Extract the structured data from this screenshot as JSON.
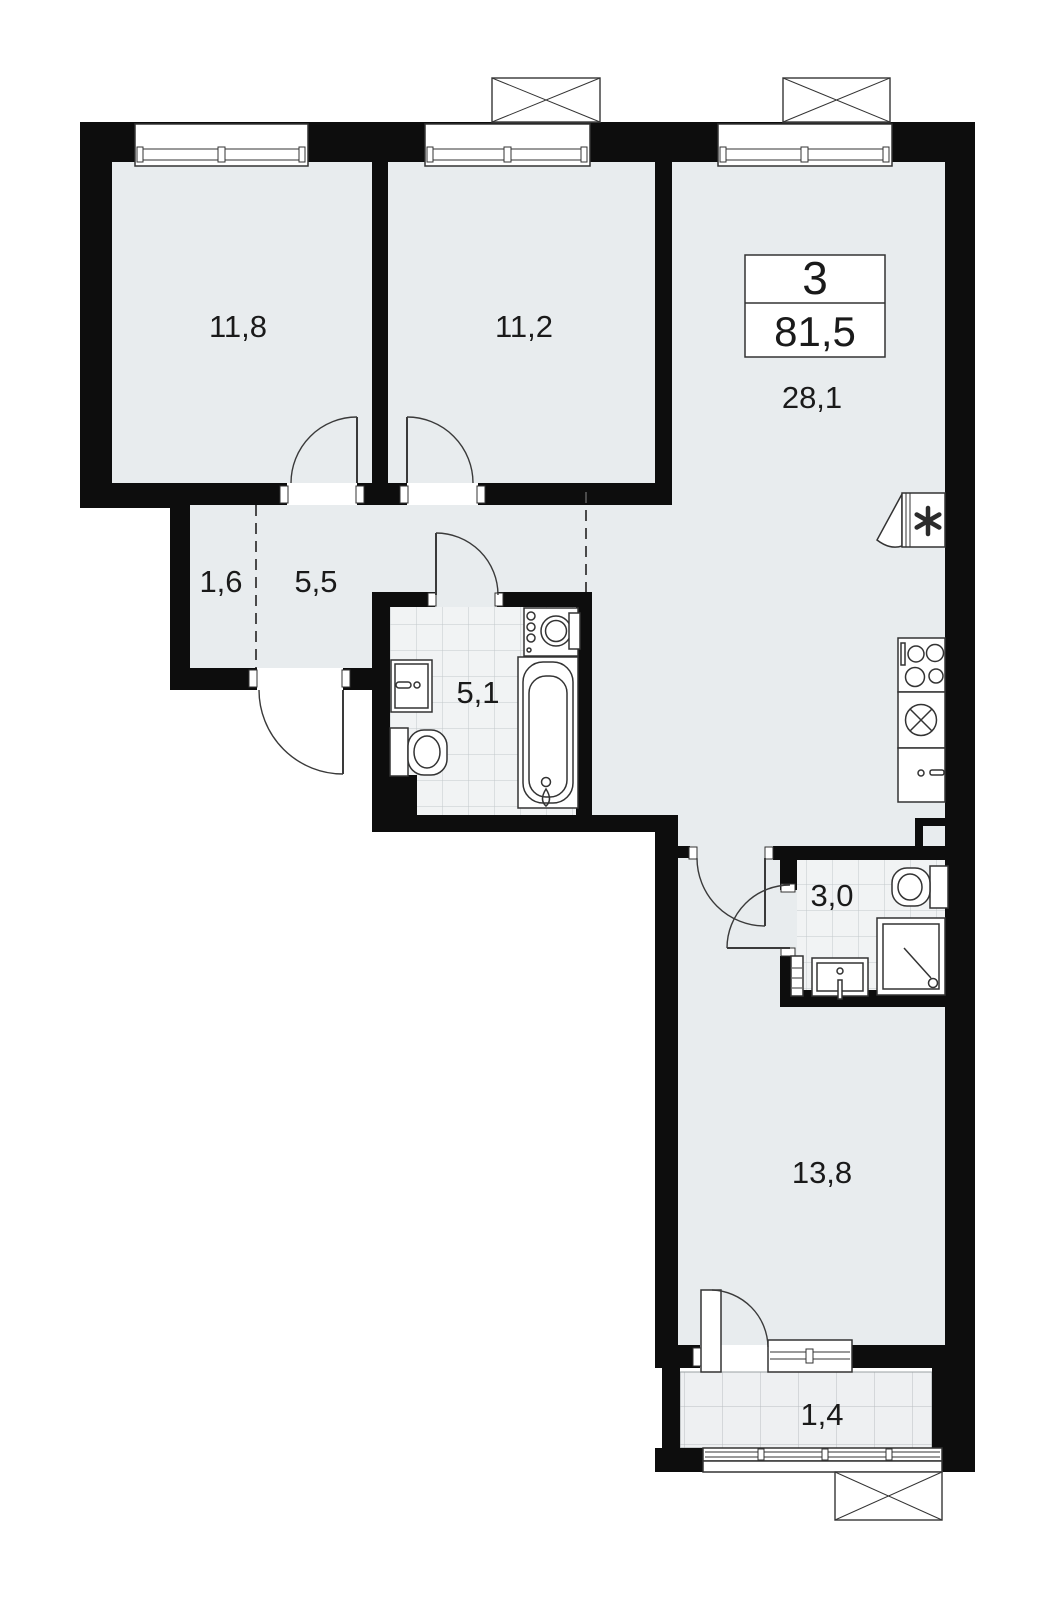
{
  "colors": {
    "wall": "#0d0d0d",
    "room-fill": "#e8ecee",
    "tile-fill": "#f1f3f4",
    "stroke": "#333333",
    "bg": "#ffffff",
    "text": "#1a1a1a"
  },
  "legend": {
    "rooms_count": "3",
    "total_area": "81,5"
  },
  "areas": {
    "bedroom1": "11,8",
    "bedroom2": "11,2",
    "kitchen_living": "28,1",
    "entry_nook": "1,6",
    "hallway": "5,5",
    "bathroom": "5,1",
    "wc": "3,0",
    "bedroom3": "13,8",
    "balcony": "1,4"
  },
  "icons": {
    "ventilation": "asterisk-star",
    "ac_unit": "crossed-box"
  }
}
